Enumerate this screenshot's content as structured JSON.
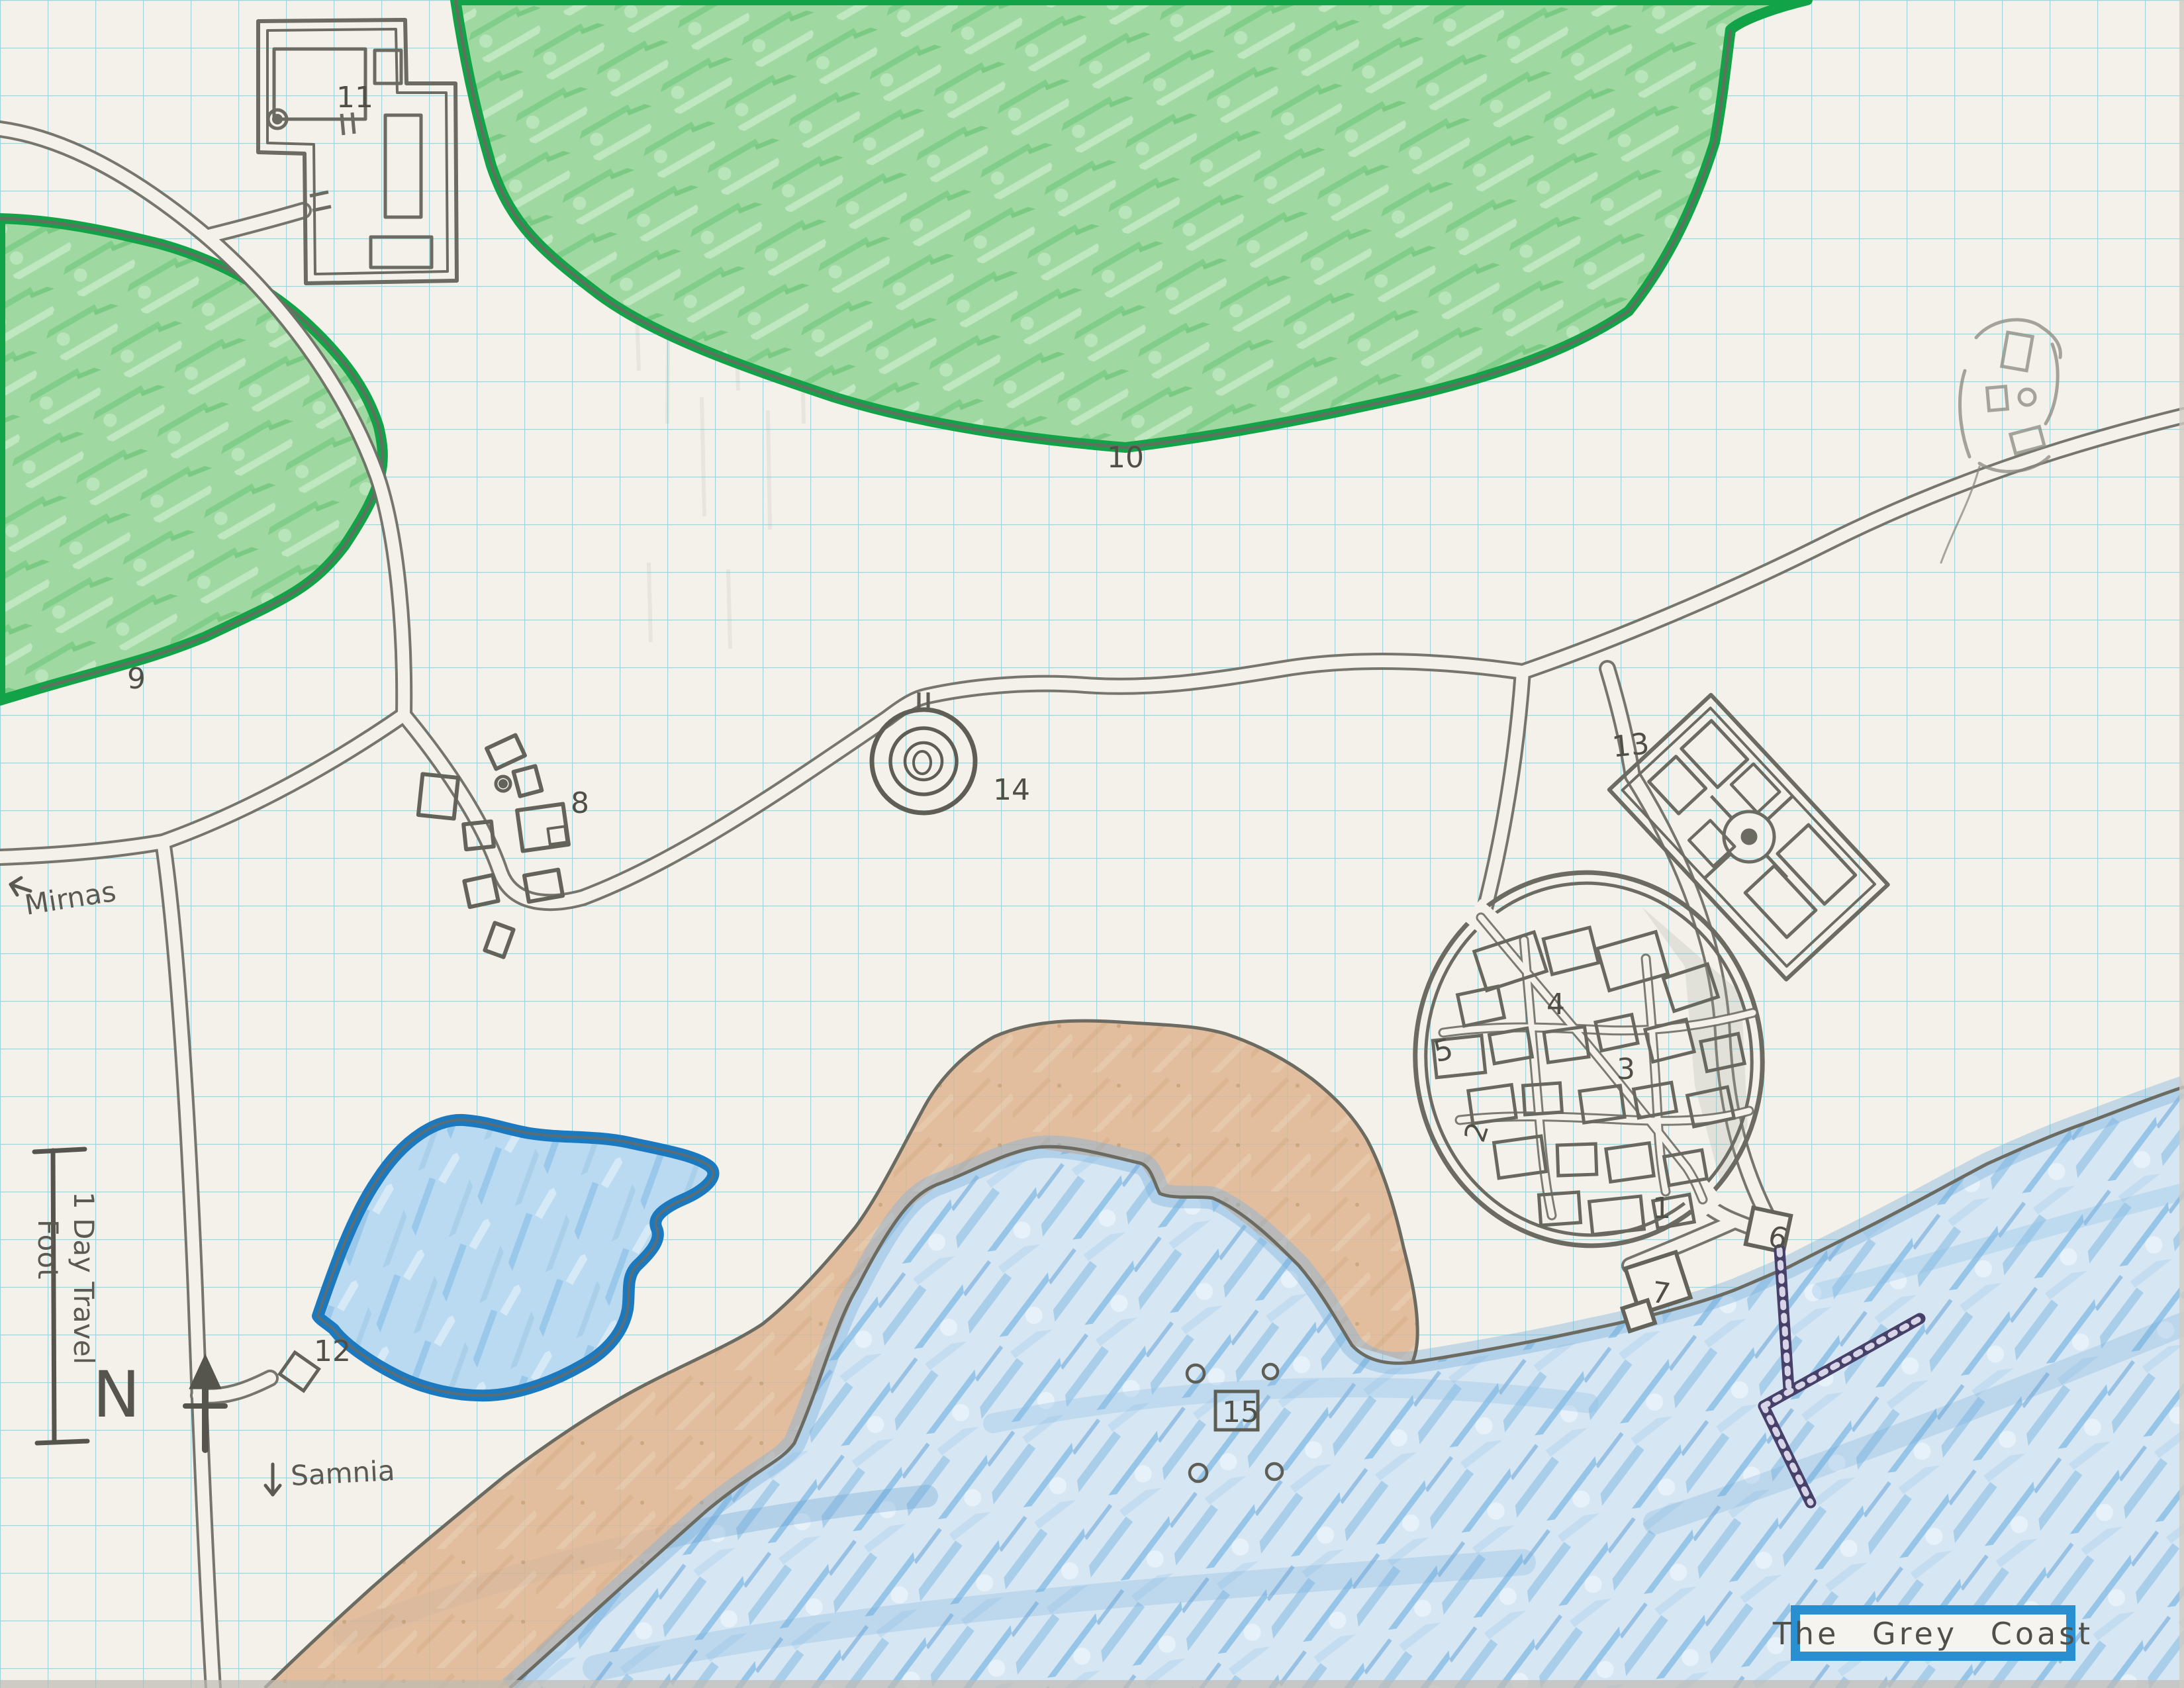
{
  "title": "The Grey Coast",
  "compass": {
    "north_label": "N"
  },
  "scale_bar": {
    "label": "1 Day Travel",
    "unit": "Foot"
  },
  "off_map": {
    "west": "Mirnas",
    "south": "Samnia"
  },
  "markers": [
    {
      "label": "1"
    },
    {
      "label": "2"
    },
    {
      "label": "3"
    },
    {
      "label": "4"
    },
    {
      "label": "5"
    },
    {
      "label": "6"
    },
    {
      "label": "7"
    },
    {
      "label": "8"
    },
    {
      "label": "9"
    },
    {
      "label": "10"
    },
    {
      "label": "11"
    },
    {
      "label": "12"
    },
    {
      "label": "13"
    },
    {
      "label": "14"
    },
    {
      "label": "15"
    }
  ],
  "colors": {
    "paper": "#f3f1e9",
    "grid": "#8ccfd8",
    "pencil": "#6b6b62",
    "forest_fill": "#a0d8a2",
    "forest_edge": "#12a348",
    "sea_fill": "#d6e7f3",
    "sea_streak": "#8bc0e5",
    "lake_edge": "#1b79c0",
    "beach": "#dfb592",
    "pier": "#474169",
    "title_box_border": "#2a8fd0"
  }
}
